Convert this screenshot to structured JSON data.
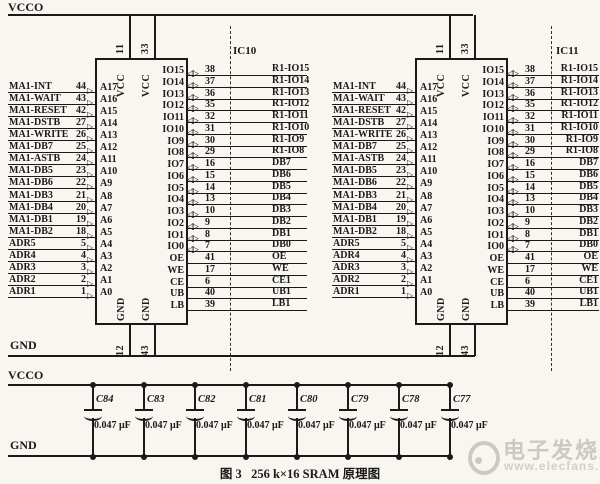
{
  "rails": {
    "vcco_top": "VCCO",
    "gnd_top": "GND",
    "vcco_bottom": "VCCO",
    "gnd_bottom": "GND"
  },
  "ics": [
    {
      "designator": "IC10",
      "top_pins": [
        {
          "pin": "11",
          "name": "VCC"
        },
        {
          "pin": "33",
          "name": "VCC"
        }
      ],
      "bottom_pins": [
        {
          "pin": "12",
          "name": "GND"
        },
        {
          "pin": "43",
          "name": "GND"
        }
      ],
      "left_pins": [
        {
          "signal": "MA1-INT",
          "pin": "44",
          "name": "A17"
        },
        {
          "signal": "MA1-WAIT",
          "pin": "43",
          "name": "A16"
        },
        {
          "signal": "MA1-RESET",
          "pin": "42",
          "name": "A15"
        },
        {
          "signal": "MA1-DSTB",
          "pin": "27",
          "name": "A14"
        },
        {
          "signal": "MA1-WRITE",
          "pin": "26",
          "name": "A13"
        },
        {
          "signal": "MA1-DB7",
          "pin": "25",
          "name": "A12"
        },
        {
          "signal": "MA1-ASTB",
          "pin": "24",
          "name": "A11"
        },
        {
          "signal": "MA1-DB5",
          "pin": "23",
          "name": "A10"
        },
        {
          "signal": "MA1-DB6",
          "pin": "22",
          "name": "A9"
        },
        {
          "signal": "MA1-DB3",
          "pin": "21",
          "name": "A8"
        },
        {
          "signal": "MA1-DB4",
          "pin": "20",
          "name": "A7"
        },
        {
          "signal": "MA1-DB1",
          "pin": "19",
          "name": "A6"
        },
        {
          "signal": "MA1-DB2",
          "pin": "18",
          "name": "A5"
        },
        {
          "signal": "ADR5",
          "pin": "5",
          "name": "A4"
        },
        {
          "signal": "ADR4",
          "pin": "4",
          "name": "A3"
        },
        {
          "signal": "ADR3",
          "pin": "3",
          "name": "A2"
        },
        {
          "signal": "ADR2",
          "pin": "2",
          "name": "A1"
        },
        {
          "signal": "ADR1",
          "pin": "1",
          "name": "A0"
        }
      ],
      "right_pins": [
        {
          "name": "IO15",
          "pin": "38",
          "signal": "R1-IO15",
          "buffer": true
        },
        {
          "name": "IO14",
          "pin": "37",
          "signal": "R1-IO14",
          "buffer": true
        },
        {
          "name": "IO13",
          "pin": "36",
          "signal": "R1-IO13",
          "buffer": true
        },
        {
          "name": "IO12",
          "pin": "35",
          "signal": "R1-IO12",
          "buffer": true
        },
        {
          "name": "IO11",
          "pin": "32",
          "signal": "R1-IO11",
          "buffer": true
        },
        {
          "name": "IO10",
          "pin": "31",
          "signal": "R1-IO10",
          "buffer": true
        },
        {
          "name": "IO9",
          "pin": "30",
          "signal": "R1-IO9",
          "buffer": true
        },
        {
          "name": "IO8",
          "pin": "29",
          "signal": "R1-IO8",
          "buffer": true
        },
        {
          "name": "IO7",
          "pin": "16",
          "signal": "DB7",
          "buffer": true
        },
        {
          "name": "IO6",
          "pin": "15",
          "signal": "DB6",
          "buffer": true
        },
        {
          "name": "IO5",
          "pin": "14",
          "signal": "DB5",
          "buffer": true
        },
        {
          "name": "IO4",
          "pin": "13",
          "signal": "DB4",
          "buffer": true
        },
        {
          "name": "IO3",
          "pin": "10",
          "signal": "DB3",
          "buffer": true
        },
        {
          "name": "IO2",
          "pin": "9",
          "signal": "DB2",
          "buffer": true
        },
        {
          "name": "IO1",
          "pin": "8",
          "signal": "DB1",
          "buffer": true
        },
        {
          "name": "IO0",
          "pin": "7",
          "signal": "DB0",
          "buffer": true
        },
        {
          "name": "OE",
          "pin": "41",
          "signal": "OE",
          "buffer": false
        },
        {
          "name": "WE",
          "pin": "17",
          "signal": "WE",
          "buffer": false
        },
        {
          "name": "CE",
          "pin": "6",
          "signal": "CE1",
          "buffer": false
        },
        {
          "name": "UB",
          "pin": "40",
          "signal": "UB1",
          "buffer": false
        },
        {
          "name": "LB",
          "pin": "39",
          "signal": "LB1",
          "buffer": false
        }
      ]
    },
    {
      "designator": "IC11",
      "top_pins": [
        {
          "pin": "11",
          "name": "VCC"
        },
        {
          "pin": "33",
          "name": "VCC"
        }
      ],
      "bottom_pins": [
        {
          "pin": "12",
          "name": "GND"
        },
        {
          "pin": "43",
          "name": "GND"
        }
      ],
      "left_pins": [
        {
          "signal": "MA1-INT",
          "pin": "44",
          "name": "A17"
        },
        {
          "signal": "MA1-WAIT",
          "pin": "43",
          "name": "A16"
        },
        {
          "signal": "MA1-RESET",
          "pin": "42",
          "name": "A15"
        },
        {
          "signal": "MA1-DSTB",
          "pin": "27",
          "name": "A14"
        },
        {
          "signal": "MA1-WRITE",
          "pin": "26",
          "name": "A13"
        },
        {
          "signal": "MA1-DB7",
          "pin": "25",
          "name": "A12"
        },
        {
          "signal": "MA1-ASTB",
          "pin": "24",
          "name": "A11"
        },
        {
          "signal": "MA1-DB5",
          "pin": "23",
          "name": "A10"
        },
        {
          "signal": "MA1-DB6",
          "pin": "22",
          "name": "A9"
        },
        {
          "signal": "MA1-DB3",
          "pin": "21",
          "name": "A8"
        },
        {
          "signal": "MA1-DB4",
          "pin": "20",
          "name": "A7"
        },
        {
          "signal": "MA1-DB1",
          "pin": "19",
          "name": "A6"
        },
        {
          "signal": "MA1-DB2",
          "pin": "18",
          "name": "A5"
        },
        {
          "signal": "ADR5",
          "pin": "5",
          "name": "A4"
        },
        {
          "signal": "ADR4",
          "pin": "4",
          "name": "A3"
        },
        {
          "signal": "ADR3",
          "pin": "3",
          "name": "A2"
        },
        {
          "signal": "ADR2",
          "pin": "2",
          "name": "A1"
        },
        {
          "signal": "ADR1",
          "pin": "1",
          "name": "A0"
        }
      ],
      "right_pins": [
        {
          "name": "IO15",
          "pin": "38",
          "signal": "R1-IO15",
          "buffer": true
        },
        {
          "name": "IO14",
          "pin": "37",
          "signal": "R1-IO14",
          "buffer": true
        },
        {
          "name": "IO13",
          "pin": "36",
          "signal": "R1-IO13",
          "buffer": true
        },
        {
          "name": "IO12",
          "pin": "35",
          "signal": "R1-IO12",
          "buffer": true
        },
        {
          "name": "IO11",
          "pin": "32",
          "signal": "R1-IO11",
          "buffer": true
        },
        {
          "name": "IO10",
          "pin": "31",
          "signal": "R1-IO10",
          "buffer": true
        },
        {
          "name": "IO9",
          "pin": "30",
          "signal": "R1-IO9",
          "buffer": true
        },
        {
          "name": "IO8",
          "pin": "29",
          "signal": "R1-IO8",
          "buffer": true
        },
        {
          "name": "IO7",
          "pin": "16",
          "signal": "DB7",
          "buffer": true
        },
        {
          "name": "IO6",
          "pin": "15",
          "signal": "DB6",
          "buffer": true
        },
        {
          "name": "IO5",
          "pin": "14",
          "signal": "DB5",
          "buffer": true
        },
        {
          "name": "IO4",
          "pin": "13",
          "signal": "DB4",
          "buffer": true
        },
        {
          "name": "IO3",
          "pin": "10",
          "signal": "DB3",
          "buffer": true
        },
        {
          "name": "IO2",
          "pin": "9",
          "signal": "DB2",
          "buffer": true
        },
        {
          "name": "IO1",
          "pin": "8",
          "signal": "DB1",
          "buffer": true
        },
        {
          "name": "IO0",
          "pin": "7",
          "signal": "DB0",
          "buffer": true
        },
        {
          "name": "OE",
          "pin": "41",
          "signal": "OE",
          "buffer": false
        },
        {
          "name": "WE",
          "pin": "17",
          "signal": "WE",
          "buffer": false
        },
        {
          "name": "CE",
          "pin": "6",
          "signal": "CE1",
          "buffer": false
        },
        {
          "name": "UB",
          "pin": "40",
          "signal": "UB1",
          "buffer": false
        },
        {
          "name": "LB",
          "pin": "39",
          "signal": "LB1",
          "buffer": false
        }
      ]
    }
  ],
  "capacitors": {
    "items": [
      {
        "ref": "C84",
        "value": "0.047 μF"
      },
      {
        "ref": "C83",
        "value": "0.047 μF"
      },
      {
        "ref": "C82",
        "value": "0.047 μF"
      },
      {
        "ref": "C81",
        "value": "0.047 μF"
      },
      {
        "ref": "C80",
        "value": "0.047 μF"
      },
      {
        "ref": "C79",
        "value": "0.047 μF"
      },
      {
        "ref": "C78",
        "value": "0.047 μF"
      },
      {
        "ref": "C77",
        "value": "0.047 μF"
      }
    ]
  },
  "caption": "图 3   256 k×16 SRAM 原理图",
  "watermark": {
    "brand": "电子发烧友",
    "url": "www.elecfans.com"
  }
}
